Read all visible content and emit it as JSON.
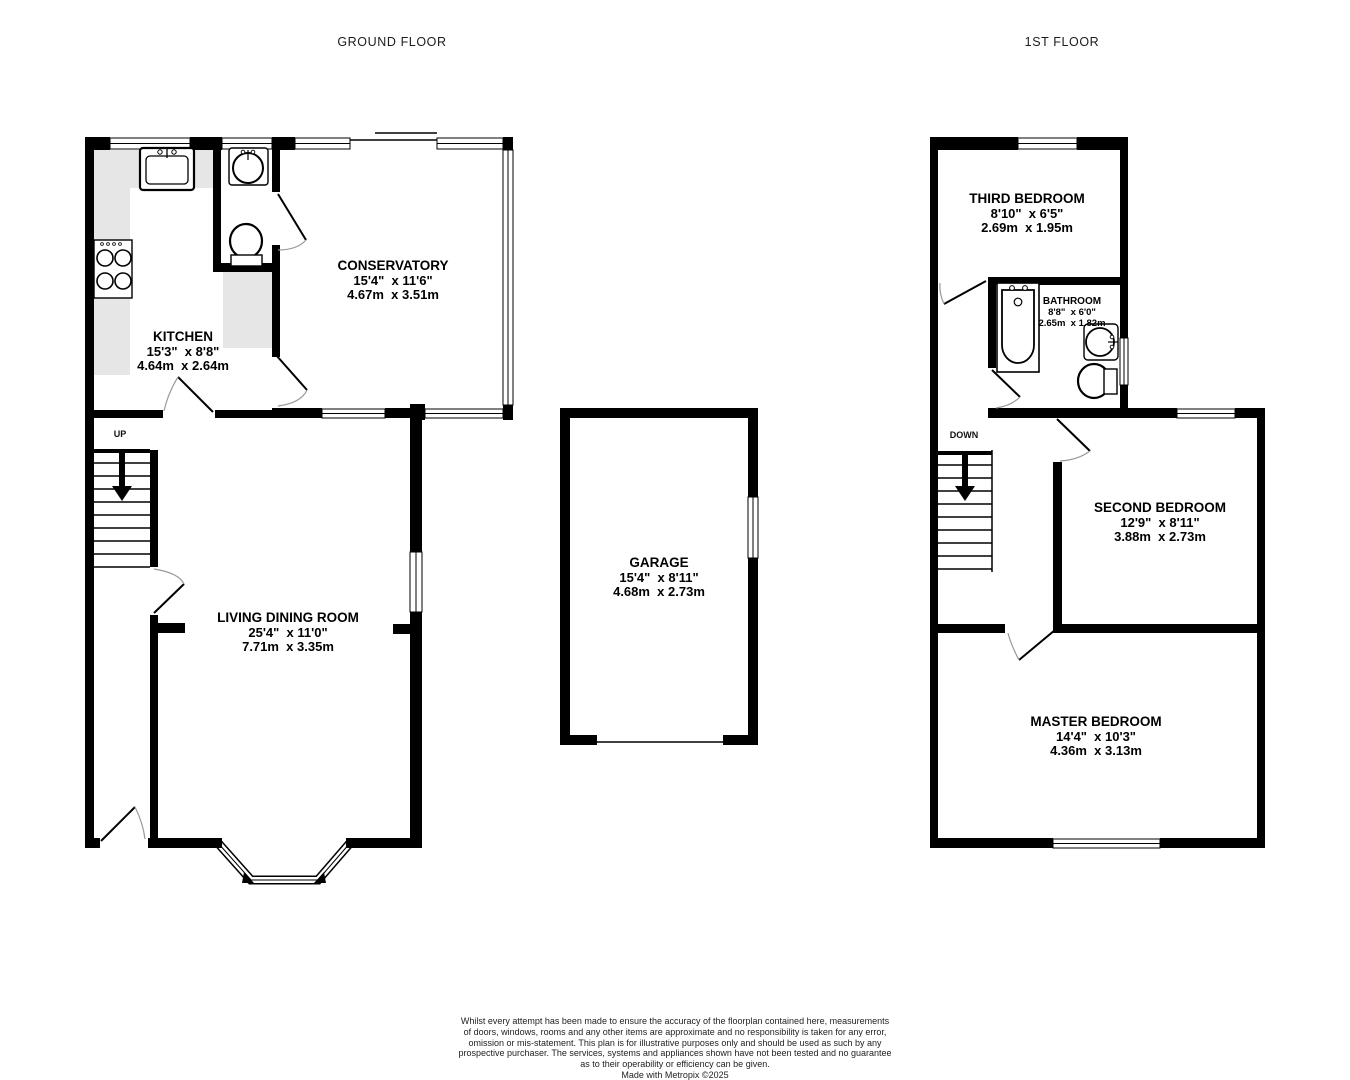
{
  "ground": {
    "title": "GROUND FLOOR",
    "stairs": "UP",
    "rooms": {
      "kitchen": {
        "name": "KITCHEN",
        "imperial": "15'3\"  x 8'8\"",
        "metric": "4.64m  x 2.64m"
      },
      "conservatory": {
        "name": "CONSERVATORY",
        "imperial": "15'4\"  x 11'6\"",
        "metric": "4.67m  x 3.51m"
      },
      "living": {
        "name": "LIVING DINING ROOM",
        "imperial": "25'4\"  x 11'0\"",
        "metric": "7.71m  x 3.35m"
      }
    }
  },
  "garage": {
    "name": "GARAGE",
    "imperial": "15'4\"  x 8'11\"",
    "metric": "4.68m  x 2.73m"
  },
  "first": {
    "title": "1ST FLOOR",
    "stairs": "DOWN",
    "rooms": {
      "third": {
        "name": "THIRD BEDROOM",
        "imperial": "8'10\"  x 6'5\"",
        "metric": "2.69m  x 1.95m"
      },
      "bathroom": {
        "name": "BATHROOM",
        "imperial": "8'8\"  x 6'0\"",
        "metric": "2.65m  x 1.82m"
      },
      "second": {
        "name": "SECOND BEDROOM",
        "imperial": "12'9\"  x 8'11\"",
        "metric": "3.88m  x 2.73m"
      },
      "master": {
        "name": "MASTER BEDROOM",
        "imperial": "14'4\"  x 10'3\"",
        "metric": "4.36m  x 3.13m"
      }
    }
  },
  "disclaimer": {
    "lines": [
      "Whilst every attempt has been made to ensure the accuracy of the floorplan contained here, measurements",
      "of doors, windows, rooms and any other items are approximate and no responsibility is taken for any error,",
      "omission or mis-statement. This plan is for illustrative purposes only and should be used as such by any",
      "prospective purchaser. The services, systems and appliances shown have not been tested and no guarantee",
      "as to their operability or efficiency can be given.",
      "Made with Metropix ©2025"
    ]
  },
  "colors": {
    "wall": "#000000",
    "counter": "#e6e6e6",
    "door_arc": "#999999",
    "background": "#ffffff"
  }
}
